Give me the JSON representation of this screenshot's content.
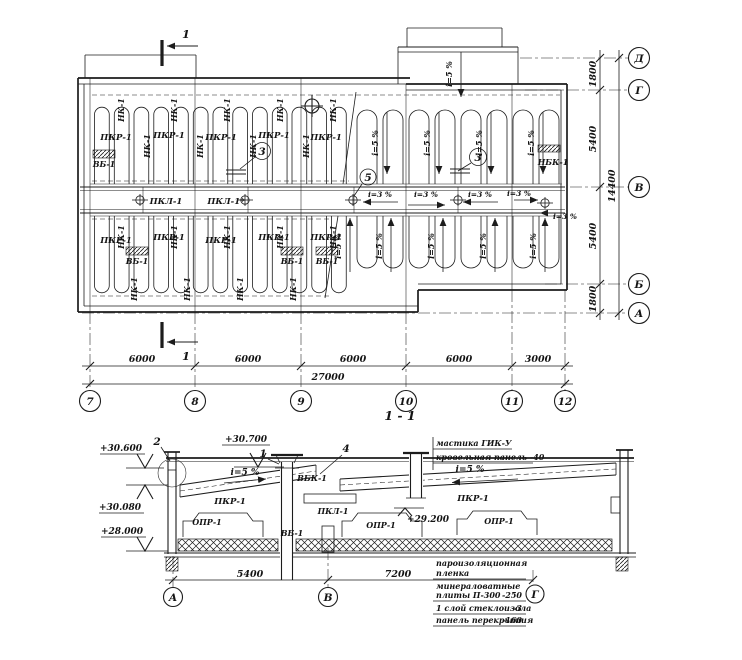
{
  "plan": {
    "cut_label": "1",
    "labels": {
      "pkr": "ПКР-1",
      "nk": "НК-1",
      "vb": "ВБ-1",
      "pkl": "ПКЛ-1",
      "pkl_star": "ПКЛ-1*",
      "nbk": "НБК-1"
    },
    "slope_main": "i=5 %",
    "slope_valley": "i=3 %",
    "callout_3": "3",
    "callout_5": "5",
    "col_axes": [
      "7",
      "8",
      "9",
      "10",
      "11",
      "12"
    ],
    "row_axes": [
      "Д",
      "Г",
      "В",
      "Б",
      "А"
    ],
    "dims_bottom": [
      "6000",
      "6000",
      "6000",
      "6000",
      "3000"
    ],
    "dim_bottom_total": "27000",
    "dims_right": [
      "1800",
      "5400",
      "5400",
      "1800"
    ],
    "dim_right_total": "14400"
  },
  "section": {
    "title": "1 - 1",
    "elevations": {
      "parapet": "+30.600",
      "ridge": "+30.700",
      "bearing": "+30.080",
      "floor": "+28.000",
      "mid": "+29.200"
    },
    "callouts": {
      "c1": "1",
      "c2": "2",
      "c4": "4"
    },
    "labels": {
      "pkr": "ПКР-1",
      "vbk": "ВБК-1",
      "pkl": "ПКЛ-1",
      "vb": "ВБ-1",
      "opr": "ОПР-1"
    },
    "slope": "i=5 %",
    "dims": [
      "5400",
      "7200"
    ],
    "axes": [
      "А",
      "В",
      "Г"
    ],
    "notes": {
      "top1": "мастика ГИК-У",
      "top2": "кровельная панель -40",
      "b1": "пароизоляционная",
      "b2": "пленка",
      "b3": "минераловатные",
      "b4": "плиты П-300",
      "b4v": "-250",
      "b5": "1 слой стеклоизола",
      "b5v": "-3",
      "b6": "панель перекрытия",
      "b6v": "-160"
    }
  }
}
